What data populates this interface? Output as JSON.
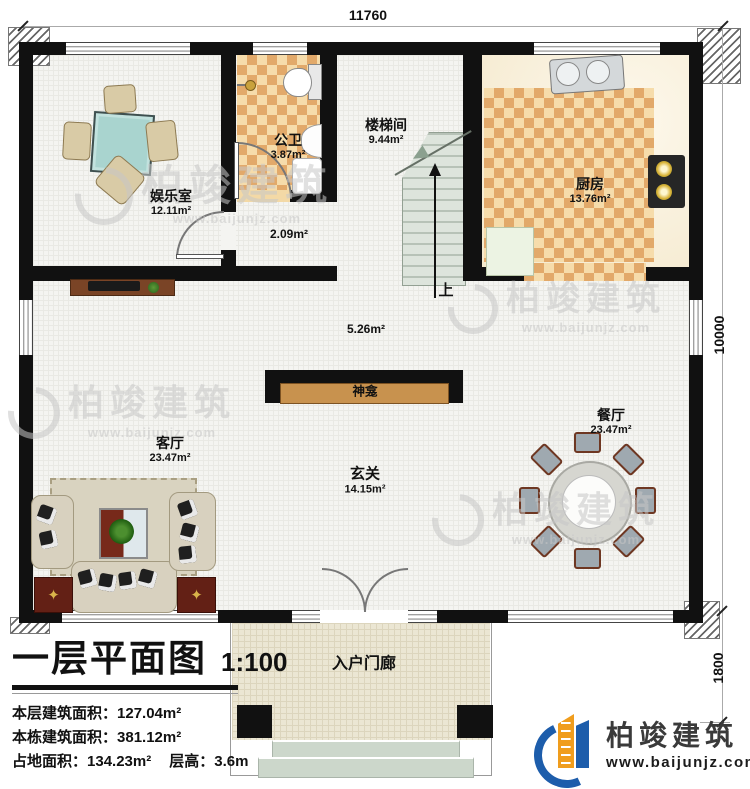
{
  "dimensions": {
    "top": "11760",
    "side": "10000",
    "porch_side": "1800"
  },
  "rooms": {
    "entertainment": {
      "name": "娱乐室",
      "area": "12.11m²"
    },
    "bathroom": {
      "name": "公卫",
      "area": "3.87m²"
    },
    "hallway": {
      "area": "2.09m²"
    },
    "stairwell": {
      "name": "楼梯间",
      "area": "9.44m²"
    },
    "kitchen": {
      "name": "厨房",
      "area": "13.76m²"
    },
    "corridor": {
      "area": "5.26m²"
    },
    "shrine": {
      "name": "神龛"
    },
    "living": {
      "name": "客厅",
      "area": "23.47m²"
    },
    "foyer": {
      "name": "玄关",
      "area": "14.15m²"
    },
    "dining": {
      "name": "餐厅",
      "area": "23.47m²"
    },
    "porch": {
      "name": "入户门廊"
    }
  },
  "stairs": {
    "up": "上"
  },
  "title_block": {
    "title": "一层平面图",
    "scale": "1:100",
    "floor_area_label": "本层建筑面积：",
    "floor_area": "127.04m²",
    "building_area_label": "本栋建筑面积：",
    "building_area": "381.12m²",
    "footprint_label": "占地面积：",
    "footprint": "134.23m²",
    "height_label": "层高：",
    "height": "3.6m"
  },
  "watermark": {
    "name": "柏竣建筑",
    "website": "www.baijunjz.com"
  },
  "logo": {
    "name": "柏竣建筑",
    "website": "www.baijunjz.com"
  },
  "colors": {
    "wall": "#111111",
    "checker_dark": "#e2a96a",
    "checker_light": "#f6dcab",
    "shrine_wood": "#c8924e",
    "logo_blue": "#1d5dab",
    "logo_orange": "#f09d1d"
  }
}
